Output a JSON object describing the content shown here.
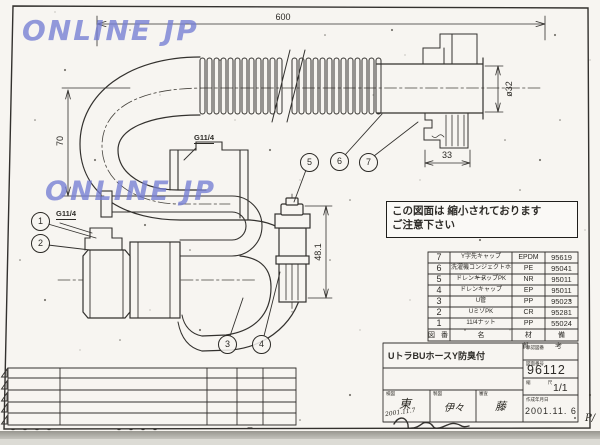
{
  "watermark": {
    "text": "ONLINE JP"
  },
  "dimensions": {
    "overall_length": "600",
    "left_height": "70",
    "pipe_diameter": "ø32",
    "cap_width": "33",
    "branch_height": "48.1",
    "thread_upper": "G11/4",
    "thread_lower": "G11/4"
  },
  "balloons": [
    "1",
    "2",
    "3",
    "4",
    "5",
    "6",
    "7"
  ],
  "note": {
    "line1": "この図面は 縮小されております",
    "line2": "ご注意下さい"
  },
  "parts_table": {
    "headers": {
      "no": "図 番",
      "name": "名",
      "material": "材 質",
      "number": "備 考"
    },
    "rows": [
      {
        "no": "7",
        "name": "Y字先キャップ",
        "material": "EPDM",
        "number": "95619"
      },
      {
        "no": "6",
        "name": "洗濯機コンジェクトホース",
        "material": "PE",
        "number": "95041"
      },
      {
        "no": "5",
        "name": "ドレンキャップPK",
        "material": "NR",
        "number": "95011"
      },
      {
        "no": "4",
        "name": "ドレンキャップ",
        "material": "EP",
        "number": "95011"
      },
      {
        "no": "3",
        "name": "U管",
        "material": "PP",
        "number": "95023"
      },
      {
        "no": "2",
        "name": "UミゾPK",
        "material": "CR",
        "number": "95281"
      },
      {
        "no": "1",
        "name": "11/4ナット",
        "material": "PP",
        "number": "55024"
      }
    ]
  },
  "title_block": {
    "title": "UトラBUホースY防臭付",
    "approval_label": "承認図番",
    "drawing_no_label": "図面番号",
    "drawing_no": "96112",
    "scale_label": "縮 尺",
    "scale": "1/1",
    "date_label": "作成年月日",
    "date": "2001.11. 6",
    "stamps": [
      {
        "label": "検図",
        "mark": "東",
        "date": "2001.11.7"
      },
      {
        "label": "製図",
        "mark": "伊々",
        "date": ""
      },
      {
        "label": "審査",
        "mark": "藤",
        "date": ""
      }
    ],
    "page_mark": "P/"
  }
}
